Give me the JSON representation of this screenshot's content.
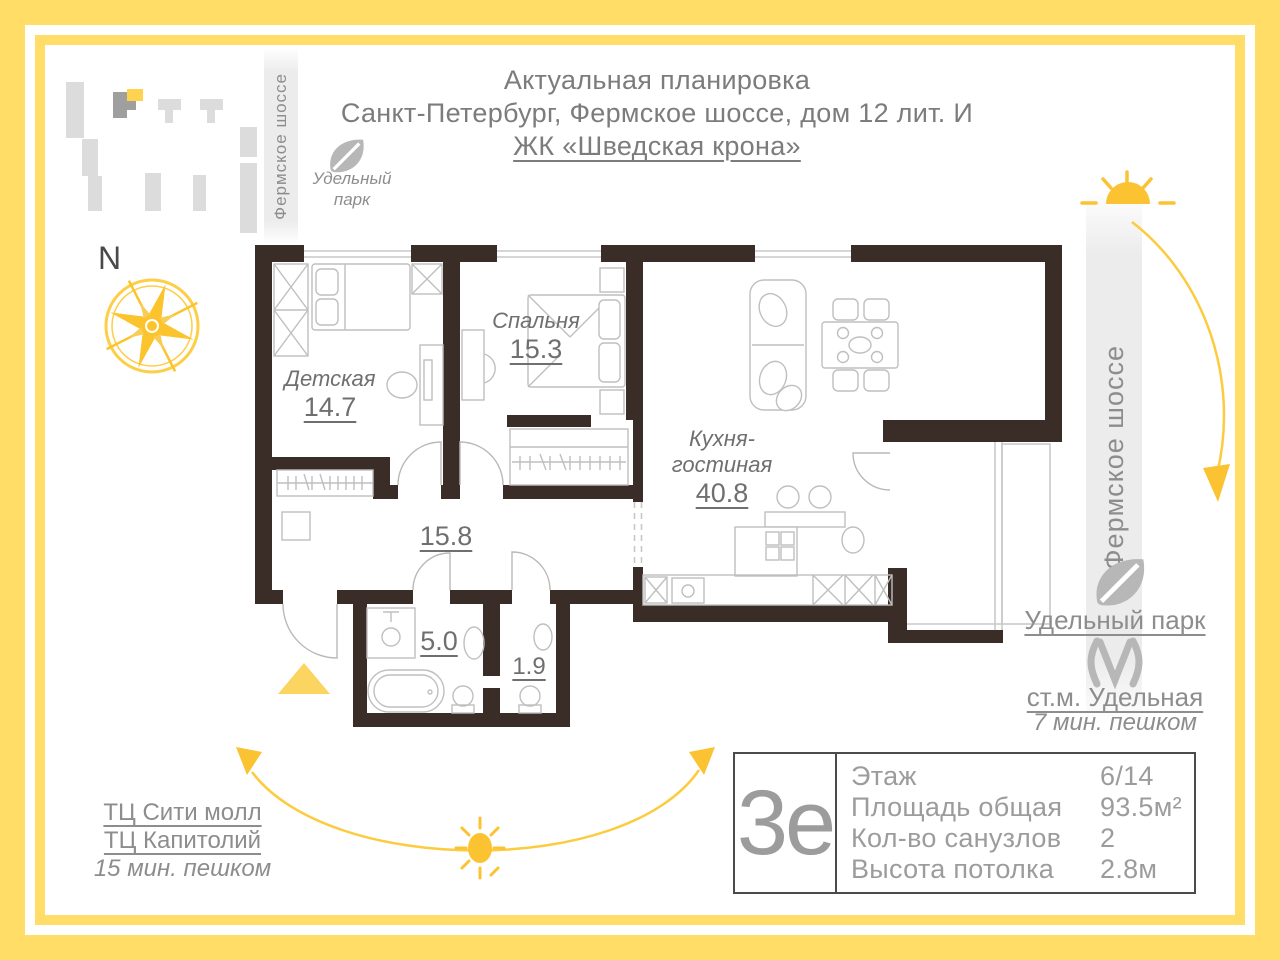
{
  "header": {
    "line1": "Актуальная планировка",
    "line2": "Санкт-Петербург, Фермское шоссе, дом 12 лит. И",
    "line3": "ЖК «Шведская крона»"
  },
  "site": {
    "road_left": "Фермское шоссе",
    "park_top": "Удельный парк",
    "compass": "N"
  },
  "plan": {
    "rooms": [
      {
        "name": "Детская",
        "area": "14.7"
      },
      {
        "name": "Спальня",
        "area": "15.3"
      },
      {
        "name": "Кухня-гостиная",
        "area": "40.8"
      }
    ],
    "hall_area": "15.8",
    "bath_area": "5.0",
    "wc_area": "1.9"
  },
  "right_side": {
    "road": "Фермское шоссе",
    "park": "Удельный парк",
    "metro": "ст.м. Удельная",
    "metro_walk": "7 мин. пешком"
  },
  "bottom_left": {
    "mall1": "ТЦ Сити молл",
    "mall2": "ТЦ Капитолий",
    "walk": "15 мин. пешком"
  },
  "card": {
    "code": "3е",
    "rows": [
      {
        "label": "Этаж",
        "value": "6/14"
      },
      {
        "label": "Площадь общая",
        "value": "93.5м²"
      },
      {
        "label": "Кол-во санузлов",
        "value": "2"
      },
      {
        "label": "Высота потолка",
        "value": "2.8м"
      }
    ]
  },
  "colors": {
    "frame_yellow": "#FFDD66",
    "accent_yellow": "#FBC332",
    "wall_dark": "#3A2D27",
    "text_gray": "#7C7C7C"
  }
}
